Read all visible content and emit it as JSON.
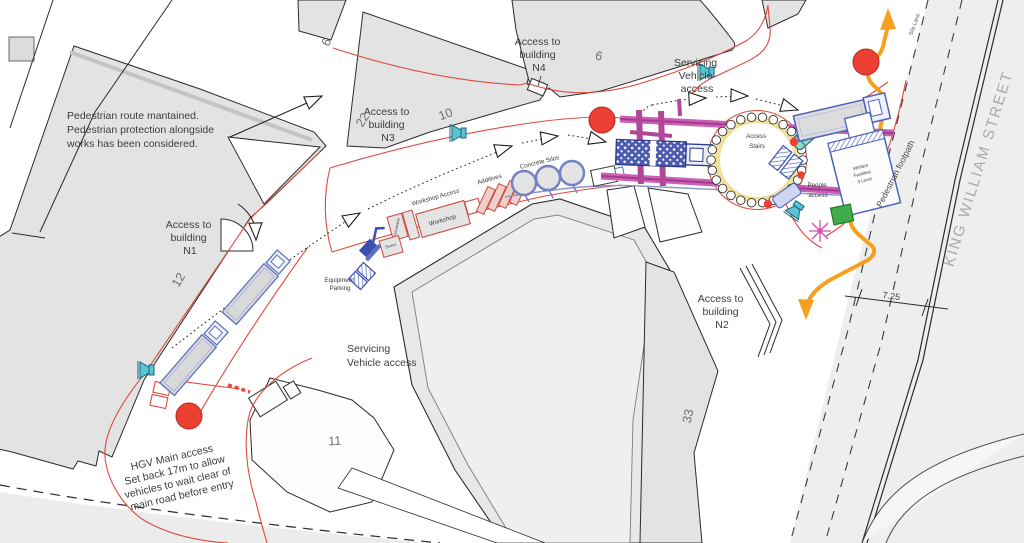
{
  "title": "Site logistics plan",
  "colors": {
    "route_red": "#dd4a3d",
    "route_orange": "#f5a01f",
    "gantry_magenta": "#c45bb0",
    "equipment_blue": "#4d62b8",
    "signal_teal": "#58c5d4",
    "marker_red": "#ed4034",
    "marker_green": "#3fae4a",
    "building_gray": "#e3e3e3"
  },
  "labels": {
    "note": {
      "lines": [
        "Pedestrian route mantained.",
        "Pedestrian protection alongside",
        "works has been considered."
      ]
    },
    "access_n1": {
      "lines": [
        "Access to",
        "building",
        "N1"
      ]
    },
    "access_n3": {
      "lines": [
        "Access to",
        "building",
        "N3"
      ]
    },
    "access_n4": {
      "lines": [
        "Access to",
        "building",
        "N4"
      ]
    },
    "access_n2": {
      "lines": [
        "Access to",
        "building",
        "N2"
      ]
    },
    "servicing_top": {
      "lines": [
        "Servicing",
        "Vehicle",
        "access"
      ]
    },
    "servicing_bottom": {
      "lines": [
        "Servicing",
        "Vehicle access"
      ]
    },
    "hgv_note": {
      "lines": [
        "HGV Main access",
        "Set back 17m to allow",
        "vehicles to wait clear of",
        "main road before entry"
      ]
    },
    "equipment_parking": {
      "lines": [
        "Equipment",
        "Parking"
      ]
    },
    "workshop_access": "Workshop Access",
    "workshop": "Workshop",
    "additives": "Additives",
    "concrete_silos": "Concrete Silos",
    "access_stairs": {
      "lines": [
        "Access",
        "Stairs"
      ]
    },
    "people_access": {
      "lines": [
        "People",
        "access"
      ]
    },
    "welfare": {
      "lines": [
        "Welfare",
        "Facilities",
        "3 Level"
      ]
    },
    "small_box_a": "Stores",
    "small_box_b": "Generator",
    "pedestrian_footpath": "Pedestrian footpath",
    "king_william_street": "KING WILLIAM STREET",
    "slip_lane": "Slip Lane",
    "dimension": "7.25",
    "numbers": {
      "b6a": "6",
      "b22": "22",
      "b10": "10",
      "b6b": "6",
      "b12": "12",
      "b11": "11",
      "b33": "33"
    }
  }
}
